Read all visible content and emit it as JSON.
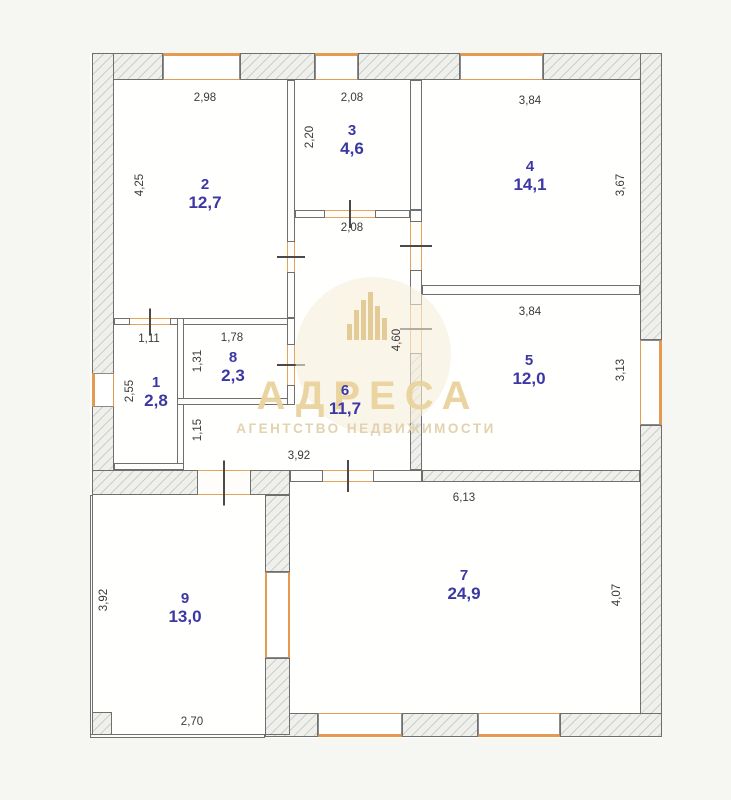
{
  "watermark": {
    "title": "АДРЕСА",
    "subtitle": "АГЕНТСТВО НЕДВИЖИМОСТИ"
  },
  "colors": {
    "wall_line": "#6f6f6f",
    "hatch_fill": "#eff0ec",
    "window_orange": "#e59a52",
    "door_orange": "#e5a35f",
    "room_label_blue": "#3c38a3",
    "dimension_text": "#3a3a3a",
    "floor": "#fffffe",
    "page_background": "#f6f6f3",
    "watermark_beige": "#e9d29c"
  },
  "rooms": [
    {
      "number": "2",
      "area": "12,7",
      "cx": 205,
      "ty": 176
    },
    {
      "number": "3",
      "area": "4,6",
      "cx": 352,
      "ty": 122
    },
    {
      "number": "4",
      "area": "14,1",
      "cx": 530,
      "ty": 158
    },
    {
      "number": "5",
      "area": "12,0",
      "cx": 529,
      "ty": 352
    },
    {
      "number": "6",
      "area": "11,7",
      "cx": 345,
      "ty": 382
    },
    {
      "number": "1",
      "area": "2,8",
      "cx": 156,
      "ty": 374
    },
    {
      "number": "8",
      "area": "2,3",
      "cx": 233,
      "ty": 349
    },
    {
      "number": "7",
      "area": "24,9",
      "cx": 464,
      "ty": 567
    },
    {
      "number": "9",
      "area": "13,0",
      "cx": 185,
      "ty": 590
    }
  ],
  "dimensions": [
    {
      "text": "2,98",
      "x": 205,
      "y": 98,
      "rot": false
    },
    {
      "text": "4,25",
      "x": 140,
      "y": 185,
      "rot": true
    },
    {
      "text": "2,08",
      "x": 352,
      "y": 98,
      "rot": false
    },
    {
      "text": "2,20",
      "x": 310,
      "y": 137,
      "rot": true
    },
    {
      "text": "3,84",
      "x": 530,
      "y": 101,
      "rot": false
    },
    {
      "text": "3,67",
      "x": 621,
      "y": 185,
      "rot": true
    },
    {
      "text": "2,08",
      "x": 352,
      "y": 228,
      "rot": false
    },
    {
      "text": "3,84",
      "x": 530,
      "y": 312,
      "rot": false
    },
    {
      "text": "3,13",
      "x": 621,
      "y": 370,
      "rot": true
    },
    {
      "text": "4,60",
      "x": 397,
      "y": 340,
      "rot": true
    },
    {
      "text": "1,11",
      "x": 149,
      "y": 339,
      "rot": false
    },
    {
      "text": "2,55",
      "x": 130,
      "y": 391,
      "rot": true
    },
    {
      "text": "1,78",
      "x": 232,
      "y": 338,
      "rot": false
    },
    {
      "text": "1,31",
      "x": 198,
      "y": 361,
      "rot": true
    },
    {
      "text": "1,15",
      "x": 198,
      "y": 430,
      "rot": true
    },
    {
      "text": "3,92",
      "x": 299,
      "y": 456,
      "rot": false
    },
    {
      "text": "6,13",
      "x": 464,
      "y": 498,
      "rot": false
    },
    {
      "text": "4,07",
      "x": 617,
      "y": 595,
      "rot": true
    },
    {
      "text": "3,92",
      "x": 104,
      "y": 600,
      "rot": true
    },
    {
      "text": "2,70",
      "x": 192,
      "y": 722,
      "rot": false
    }
  ],
  "geometry": {
    "floor": {
      "x": 90,
      "y": 53,
      "w": 572,
      "h": 685
    },
    "hatched_walls": [
      {
        "x": 92,
        "y": 53,
        "w": 71,
        "h": 27
      },
      {
        "x": 240,
        "y": 53,
        "w": 75,
        "h": 27
      },
      {
        "x": 358,
        "y": 53,
        "w": 102,
        "h": 27
      },
      {
        "x": 543,
        "y": 53,
        "w": 119,
        "h": 27
      },
      {
        "x": 92,
        "y": 53,
        "w": 22,
        "h": 322
      },
      {
        "x": 92,
        "y": 405,
        "w": 22,
        "h": 90
      },
      {
        "x": 640,
        "y": 53,
        "w": 22,
        "h": 287
      },
      {
        "x": 640,
        "y": 425,
        "w": 22,
        "h": 310
      },
      {
        "x": 265,
        "y": 713,
        "w": 53,
        "h": 24
      },
      {
        "x": 402,
        "y": 713,
        "w": 76,
        "h": 24
      },
      {
        "x": 560,
        "y": 713,
        "w": 102,
        "h": 24
      },
      {
        "x": 92,
        "y": 470,
        "w": 106,
        "h": 25
      },
      {
        "x": 250,
        "y": 470,
        "w": 40,
        "h": 25
      },
      {
        "x": 265,
        "y": 495,
        "w": 25,
        "h": 77
      },
      {
        "x": 265,
        "y": 658,
        "w": 25,
        "h": 77
      },
      {
        "x": 90,
        "y": 712,
        "w": 22,
        "h": 25
      },
      {
        "x": 410,
        "y": 353,
        "w": 12,
        "h": 117
      },
      {
        "x": 422,
        "y": 470,
        "w": 218,
        "h": 12
      }
    ],
    "thin_walls": [
      {
        "x": 287,
        "y": 80,
        "w": 8,
        "h": 162
      },
      {
        "x": 287,
        "y": 272,
        "w": 8,
        "h": 46
      },
      {
        "x": 114,
        "y": 318,
        "w": 16,
        "h": 7
      },
      {
        "x": 170,
        "y": 318,
        "w": 125,
        "h": 7
      },
      {
        "x": 295,
        "y": 210,
        "w": 30,
        "h": 8
      },
      {
        "x": 375,
        "y": 210,
        "w": 35,
        "h": 8
      },
      {
        "x": 410,
        "y": 80,
        "w": 12,
        "h": 130
      },
      {
        "x": 410,
        "y": 210,
        "w": 12,
        "h": 12
      },
      {
        "x": 410,
        "y": 270,
        "w": 12,
        "h": 35
      },
      {
        "x": 422,
        "y": 285,
        "w": 218,
        "h": 10
      },
      {
        "x": 290,
        "y": 470,
        "w": 33,
        "h": 12
      },
      {
        "x": 373,
        "y": 470,
        "w": 49,
        "h": 12
      },
      {
        "x": 177,
        "y": 318,
        "w": 7,
        "h": 152
      },
      {
        "x": 177,
        "y": 398,
        "w": 118,
        "h": 7
      },
      {
        "x": 287,
        "y": 318,
        "w": 8,
        "h": 27
      },
      {
        "x": 287,
        "y": 385,
        "w": 8,
        "h": 20
      },
      {
        "x": 114,
        "y": 463,
        "w": 70,
        "h": 7
      },
      {
        "x": 90,
        "y": 495,
        "w": 3,
        "h": 240
      },
      {
        "x": 90,
        "y": 734,
        "w": 175,
        "h": 4
      }
    ],
    "windows": [
      {
        "x": 163,
        "y": 53,
        "w": 77,
        "h": 27,
        "edge": "top"
      },
      {
        "x": 315,
        "y": 53,
        "w": 43,
        "h": 27,
        "edge": "top"
      },
      {
        "x": 460,
        "y": 53,
        "w": 83,
        "h": 27,
        "edge": "top"
      },
      {
        "x": 92,
        "y": 373,
        "w": 22,
        "h": 34,
        "edge": "left"
      },
      {
        "x": 640,
        "y": 340,
        "w": 22,
        "h": 85,
        "edge": "right"
      },
      {
        "x": 318,
        "y": 713,
        "w": 84,
        "h": 24,
        "edge": "bottom"
      },
      {
        "x": 478,
        "y": 713,
        "w": 82,
        "h": 24,
        "edge": "bottom"
      },
      {
        "x": 265,
        "y": 572,
        "w": 25,
        "h": 86,
        "edge": "vmid"
      }
    ],
    "doors": [
      {
        "x": 130,
        "y": 318,
        "w": 40,
        "h": 7,
        "dir": "h"
      },
      {
        "x": 287,
        "y": 242,
        "w": 8,
        "h": 30,
        "dir": "v"
      },
      {
        "x": 325,
        "y": 210,
        "w": 50,
        "h": 8,
        "dir": "h"
      },
      {
        "x": 410,
        "y": 222,
        "w": 12,
        "h": 48,
        "dir": "v"
      },
      {
        "x": 410,
        "y": 305,
        "w": 12,
        "h": 48,
        "dir": "v"
      },
      {
        "x": 287,
        "y": 345,
        "w": 8,
        "h": 40,
        "dir": "v"
      },
      {
        "x": 323,
        "y": 470,
        "w": 50,
        "h": 12,
        "dir": "h"
      },
      {
        "x": 198,
        "y": 470,
        "w": 52,
        "h": 25,
        "dir": "h"
      }
    ],
    "watermark_bars": [
      16,
      30,
      40,
      48,
      34,
      22
    ]
  }
}
